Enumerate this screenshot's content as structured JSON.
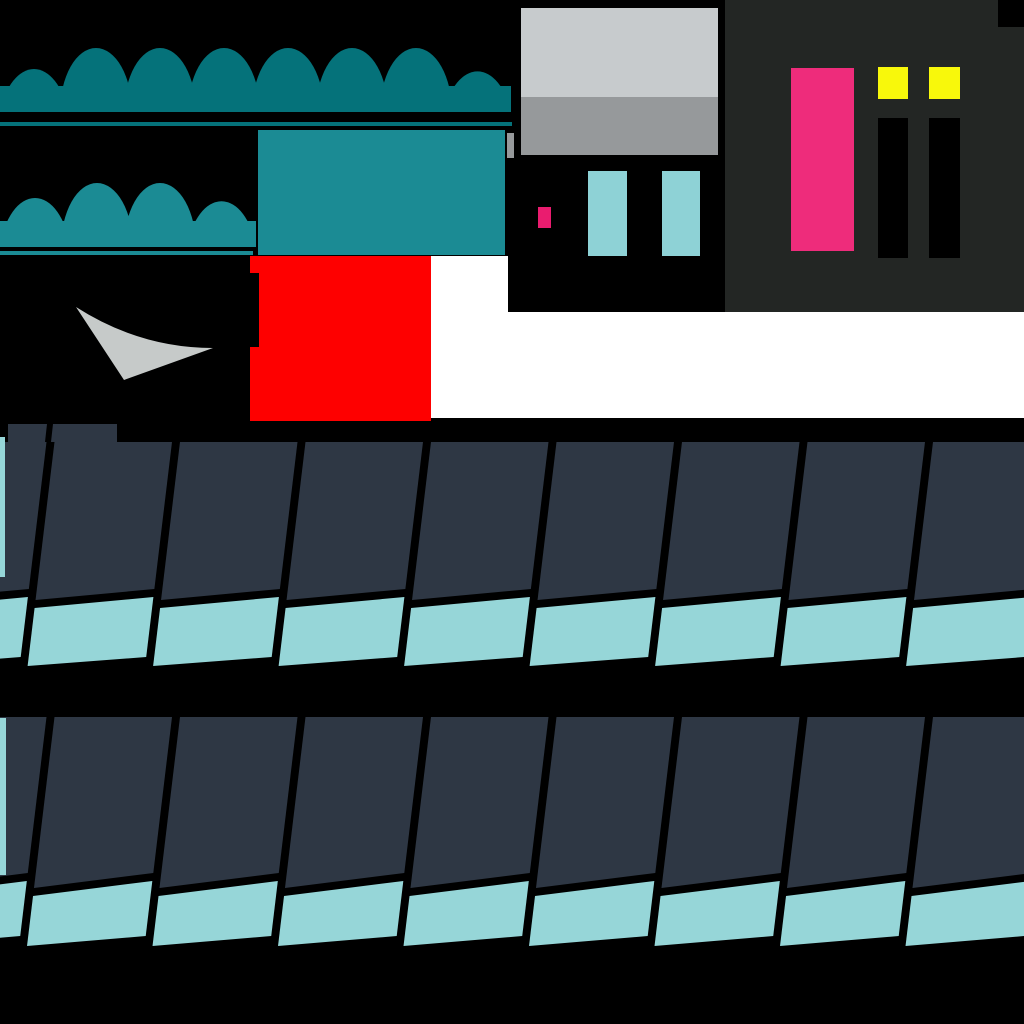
{
  "canvas": {
    "width": 1024,
    "height": 1024,
    "background": "#ffffff"
  },
  "colors": {
    "black": "#000000",
    "white": "#ffffff",
    "awning_top_teal": "#05727a",
    "awning_lower_teal": "#1b8b94",
    "red": "#fe0000",
    "swoosh_gray": "#c6cac9",
    "wall_light_gray": "#c7cbcd",
    "wall_mid_gray": "#96999b",
    "facade_charcoal": "#232624",
    "door_pink": "#ee2c7b",
    "sign_pink": "#ea1c6f",
    "window_yellow": "#f8f80b",
    "window_cyan": "#8ed2d6",
    "shingle_dark": "#2e3744",
    "shingle_teal": "#96d6d8"
  },
  "background_blocks": [
    {
      "name": "top-left-black-field",
      "x": 0,
      "y": 0,
      "w": 512,
      "h": 256,
      "color": "black"
    },
    {
      "name": "doorway-black-field",
      "x": 0,
      "y": 256,
      "w": 250,
      "h": 164,
      "color": "black"
    },
    {
      "name": "building-black-field",
      "x": 510,
      "y": 0,
      "w": 215,
      "h": 312,
      "color": "black"
    },
    {
      "name": "bottom-black-field",
      "x": 0,
      "y": 418,
      "w": 1024,
      "h": 606,
      "color": "black"
    }
  ],
  "awnings": [
    {
      "name": "awning-large",
      "color": "awning_top_teal",
      "clip_x": 0,
      "clip_w": 511,
      "dome_start_cx": 32,
      "dome_spacing": 64,
      "dome_count": 8,
      "dome_rx": 36,
      "dome_ry": 64,
      "base_y": 112,
      "trim": {
        "x": 0,
        "y": 122,
        "w": 512,
        "h": 4
      }
    },
    {
      "name": "awning-small",
      "color": "awning_lower_teal",
      "clip_x": 0,
      "clip_w": 256,
      "dome_start_cx": 34,
      "dome_spacing": 63,
      "dome_count": 4,
      "dome_rx": 36,
      "dome_ry": 64,
      "base_y": 247,
      "trim": {
        "x": 0,
        "y": 251,
        "w": 253,
        "h": 4
      }
    }
  ],
  "blocks": [
    {
      "name": "teal-rectangle",
      "x": 258,
      "y": 130,
      "w": 247,
      "h": 125,
      "color": "awning_lower_teal"
    },
    {
      "name": "red-rectangle",
      "x": 250,
      "y": 256,
      "w": 181,
      "h": 165,
      "color": "red"
    },
    {
      "name": "red-left-notch",
      "x": 250,
      "y": 273,
      "w": 9,
      "h": 74,
      "color": "black"
    },
    {
      "name": "wall-upper",
      "x": 521,
      "y": 8,
      "w": 197,
      "h": 89,
      "color": "wall_light_gray"
    },
    {
      "name": "wall-lower",
      "x": 521,
      "y": 97,
      "w": 197,
      "h": 58,
      "color": "wall_mid_gray"
    },
    {
      "name": "wall-gray-sliver",
      "x": 507,
      "y": 133,
      "w": 7,
      "h": 25,
      "color": "wall_mid_gray"
    },
    {
      "name": "seam-black-bar",
      "x": 508,
      "y": 256,
      "w": 9,
      "h": 56,
      "color": "black"
    },
    {
      "name": "window-cyan-left",
      "x": 588,
      "y": 171,
      "w": 39,
      "h": 85,
      "color": "window_cyan"
    },
    {
      "name": "window-cyan-right",
      "x": 662,
      "y": 171,
      "w": 38,
      "h": 85,
      "color": "window_cyan"
    },
    {
      "name": "sign-pink-small",
      "x": 538,
      "y": 207,
      "w": 13,
      "h": 21,
      "color": "sign_pink"
    },
    {
      "name": "facade-charcoal-panel",
      "x": 725,
      "y": 0,
      "w": 299,
      "h": 312,
      "color": "facade_charcoal"
    },
    {
      "name": "facade-corner-notch",
      "x": 998,
      "y": 0,
      "w": 26,
      "h": 27,
      "color": "black"
    },
    {
      "name": "door-pink",
      "x": 791,
      "y": 68,
      "w": 63,
      "h": 183,
      "color": "door_pink"
    },
    {
      "name": "window-yellow-left",
      "x": 878,
      "y": 67,
      "w": 30,
      "h": 32,
      "color": "window_yellow"
    },
    {
      "name": "window-yellow-right",
      "x": 929,
      "y": 67,
      "w": 31,
      "h": 32,
      "color": "window_yellow"
    },
    {
      "name": "window-black-left",
      "x": 878,
      "y": 118,
      "w": 30,
      "h": 140,
      "color": "black"
    },
    {
      "name": "window-black-right",
      "x": 929,
      "y": 118,
      "w": 31,
      "h": 140,
      "color": "black"
    }
  ],
  "swoosh": {
    "name": "swoosh",
    "path": "M76,307 Q140,348 213,348 L124,380 Z",
    "color": "swoosh_gray"
  },
  "roof_rows": [
    {
      "name": "roof-row-1",
      "top_y": 442,
      "gap_x0": 47.5,
      "unit_w": 125.5,
      "gap_w": 7,
      "gap_lean": -0.12,
      "dark_bottom_left_y": 600,
      "dark_bottom_right_y": 589,
      "strip_gap": 8,
      "teal_bottom_left_y": 666,
      "teal_bottom_right_y": 657,
      "units_from": -1,
      "units_to": 8,
      "patches": [
        {
          "points": "8,424 47,424 45,442 8,442"
        },
        {
          "points": "53,424 117,424 117,442 51,442"
        }
      ],
      "left_sliver": {
        "x": 0,
        "y": 437,
        "w": 5,
        "h": 140
      }
    },
    {
      "name": "roof-row-2",
      "top_y": 717,
      "gap_x0": 47.5,
      "unit_w": 125.5,
      "gap_w": 7,
      "gap_lean": -0.12,
      "dark_bottom_left_y": 888,
      "dark_bottom_right_y": 873,
      "strip_gap": 8,
      "teal_bottom_left_y": 946,
      "teal_bottom_right_y": 936,
      "units_from": -1,
      "units_to": 8,
      "patches": [],
      "left_sliver": {
        "x": 0,
        "y": 718,
        "w": 6,
        "h": 157
      }
    }
  ]
}
